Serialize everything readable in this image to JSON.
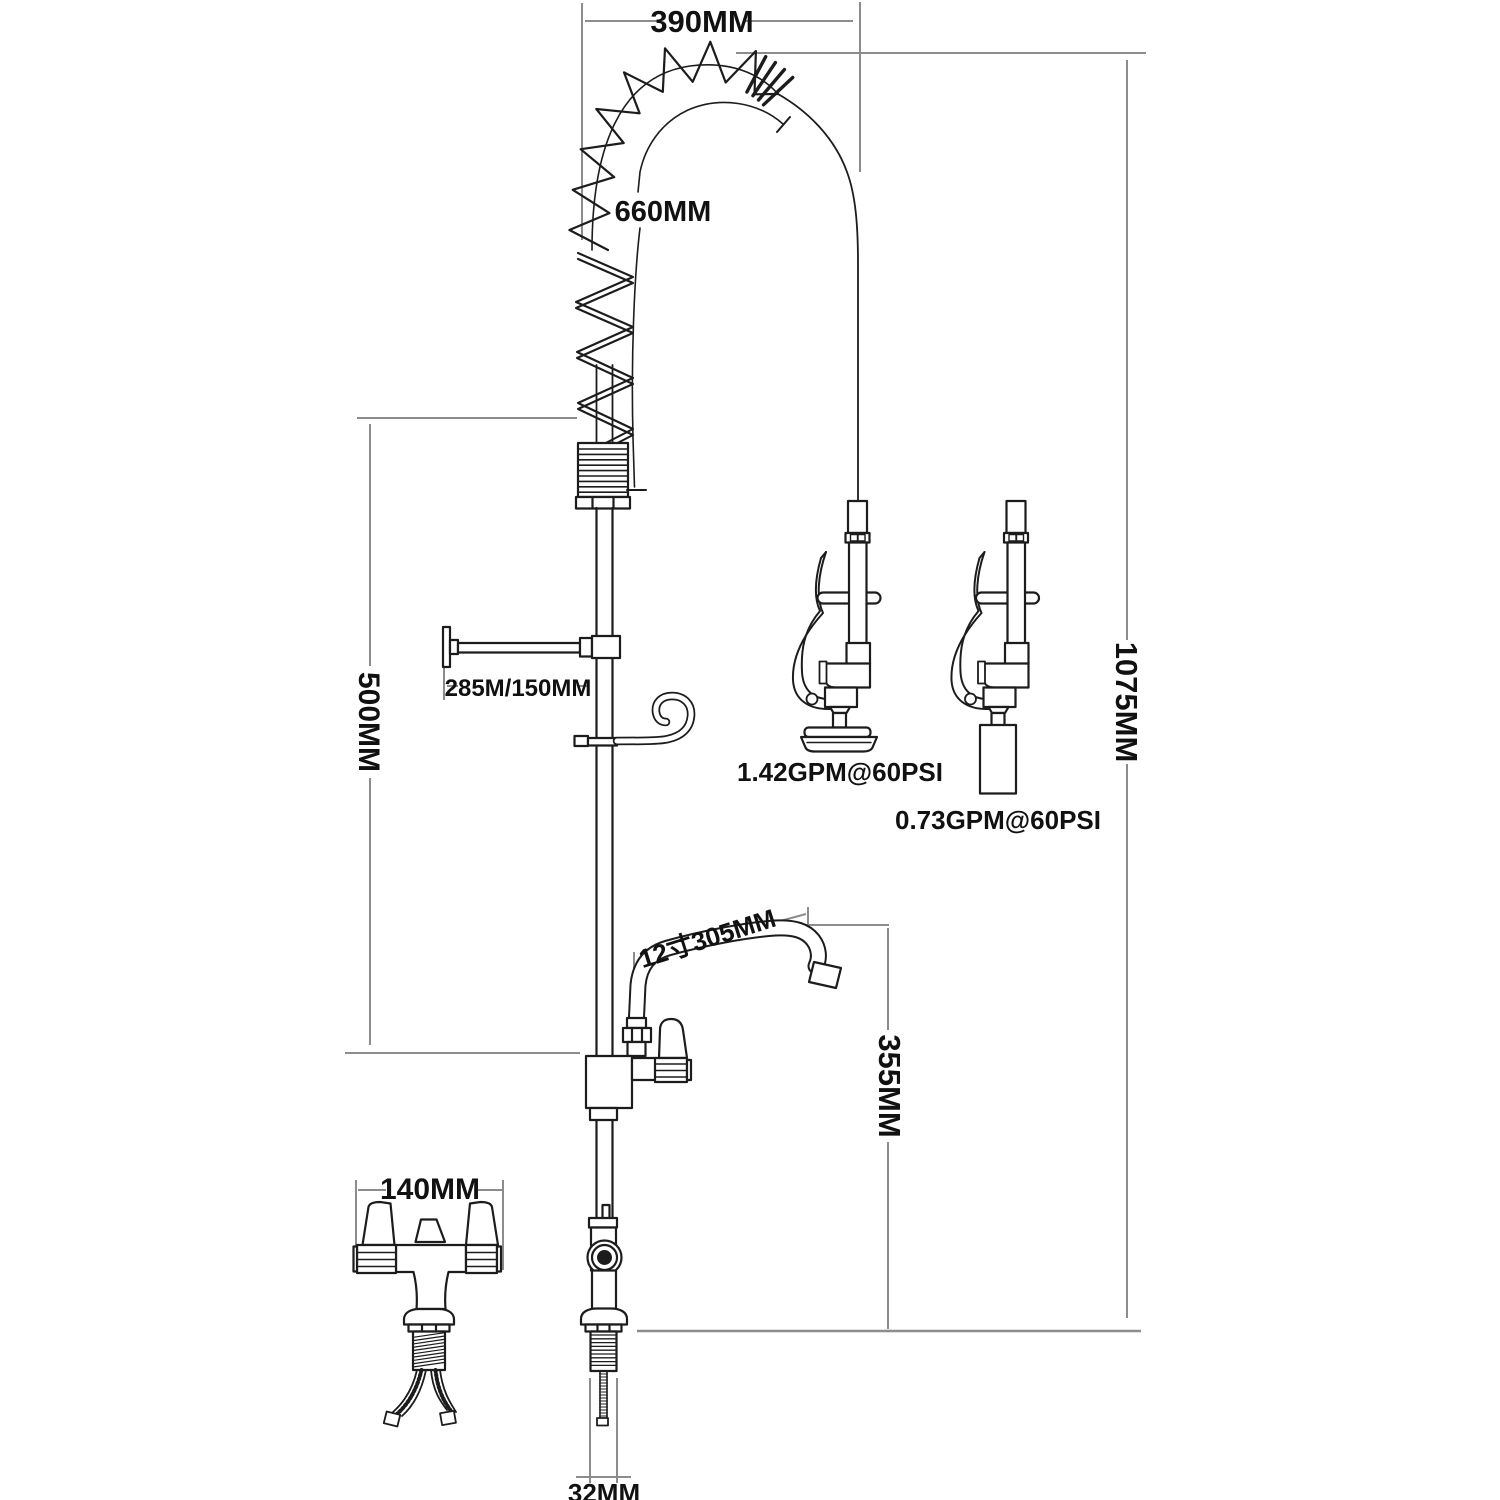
{
  "drawing": {
    "type": "technical dimension drawing",
    "subject": "commercial pre-rinse kitchen faucet with coiled spring hose, add-on swing spout and spray heads"
  },
  "dimensions": {
    "top_width": "390MM",
    "hose_length": "660MM",
    "overall_height": "1075MM",
    "riser_section": "500MM",
    "wall_bracket_reach": "285M/150MM",
    "addon_spout": "12寸305MM",
    "spout_height": "355MM",
    "mixer_width": "140MM",
    "shank": "32MM"
  },
  "flow_labels": {
    "spray_valve": "1.42GPM@60PSI",
    "low_flow_valve": "0.73GPM@60PSI"
  },
  "colors": {
    "outline": "#1c1c1c",
    "dimension": "#8c8c8c",
    "text": "#111111",
    "background": "#ffffff"
  }
}
